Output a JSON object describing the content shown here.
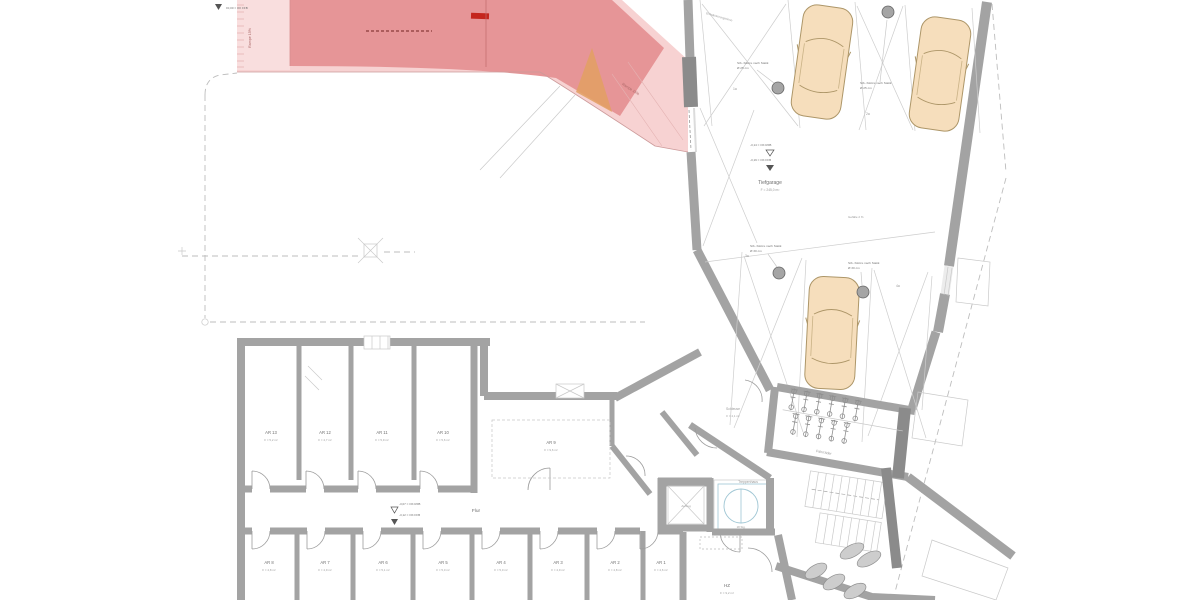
{
  "plan": {
    "ramp": {
      "label_left": "Rampe 15%",
      "label_mid": "Rampe 15%",
      "top_level": "±0,00 = OK FFB"
    },
    "garage": {
      "name": "Tiefgarage",
      "area": "F = 245,0 m²",
      "level_raw": "-3,14 = OK RFB",
      "level_fin": "-3,19 = OK FFB",
      "slope_note": "Gefälle 2 %",
      "drain_note": "Entwässerungsrinne",
      "column_notes": [
        {
          "line1": "Stb.-Stütze nach Statik",
          "line2": "Ø 25 cm"
        },
        {
          "line1": "Stb.-Stütze nach Statik",
          "line2": "Ø 25 cm"
        },
        {
          "line1": "Stb.-Stütze nach Statik",
          "line2": "Ø 30 cm"
        },
        {
          "line1": "Stb.-Stütze nach Statik",
          "line2": "Ø 30 cm"
        }
      ],
      "spots": [
        "1a",
        "2a",
        "3a",
        "4a"
      ]
    },
    "basement": {
      "corridor": {
        "name": "Flur",
        "level_raw": "-3,07 = OK RFB",
        "level_fin": "-3,12 = OK FFB"
      },
      "rooms_top": [
        {
          "name": "AR 13",
          "area": "F = 5,2 m²"
        },
        {
          "name": "AR 12",
          "area": "F = 4,7 m²"
        },
        {
          "name": "AR 11",
          "area": "F = 5,9 m²"
        },
        {
          "name": "AR 10",
          "area": "F = 5,6 m²"
        }
      ],
      "room_mid": {
        "name": "AR 9",
        "area": "F = 9,6 m²"
      },
      "rooms_bottom": [
        {
          "name": "AR 8",
          "area": "F = 4,8 m²"
        },
        {
          "name": "AR 7",
          "area": "F = 4,9 m²"
        },
        {
          "name": "AR 6",
          "area": "F = 5,1 m²"
        },
        {
          "name": "AR 5",
          "area": "F = 5,0 m²"
        },
        {
          "name": "AR 4",
          "area": "F = 5,0 m²"
        },
        {
          "name": "AR 3",
          "area": "F = 4,9 m²"
        },
        {
          "name": "AR 2",
          "area": "F = 4,8 m²"
        },
        {
          "name": "AR 1",
          "area": "F = 4,6 m²"
        }
      ],
      "elevator": {
        "name": "Aufzug"
      },
      "stair": {
        "name": "Treppenhaus",
        "steps": "18 Stg."
      },
      "bikes": {
        "name": "Fahrräder"
      },
      "vestibule": {
        "name": "Schleuse",
        "area": "F = 4,1 m²"
      },
      "heating": {
        "name": "HZ",
        "area": "F = 9,2 m²"
      }
    }
  }
}
